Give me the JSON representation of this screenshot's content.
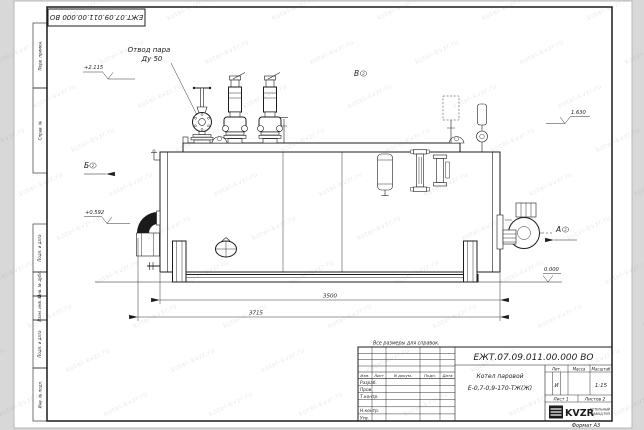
{
  "sheet": {
    "paper_note": "Все размеры для справок.",
    "format_label": "Формат А3",
    "watermark_text": "kotel-kvzr.ru"
  },
  "doc": {
    "number": "ЕЖТ.07.09.011.00.000  ВО"
  },
  "margin": {
    "cells": [
      {
        "label": "Перв. примен."
      },
      {
        "label": "Справ. №"
      },
      {
        "label": "Подп. и дата"
      },
      {
        "label": "Инв. № дубл."
      },
      {
        "label": "Взам. инв. №"
      },
      {
        "label": "Подп. и дата"
      },
      {
        "label": "Инв. № подл."
      }
    ]
  },
  "drawing": {
    "callout": {
      "line1": "Отвод пара",
      "line2": "Ду 50"
    },
    "views": {
      "b": "Б",
      "v": "В",
      "a": "А",
      "ref": "2"
    },
    "elevations": {
      "e1": "+2.115",
      "e2": "+0.592",
      "e3": "1.630",
      "e4": "0.000"
    },
    "dims": {
      "inner": "3500",
      "overall": "3715"
    }
  },
  "title": {
    "product_name": "Котел паровой",
    "product_code": "Е-0,7-0,9-170-ТЖ(Ж)",
    "headers": {
      "izm": "Изм.",
      "list": "Лист",
      "doc": "N докум.",
      "podp": "Подп.",
      "data": "Дата",
      "lit": "Лит.",
      "massa": "Масса",
      "masshtab": "Масштаб"
    },
    "rows": {
      "razrab": "Разраб.",
      "prov": "Пров.",
      "tkontr": "Т.контр.",
      "nkontr": "Н.контр.",
      "utv": "Утв."
    },
    "lit_value": "И",
    "scale_value": "1:15",
    "sheet_no": "Лист 1",
    "sheets_total": "Листов 2",
    "company": {
      "logo_text": "KVZR",
      "line1": "КОТЕЛЬНЫЙ",
      "line2": "ЗАВОД РЭП"
    }
  }
}
